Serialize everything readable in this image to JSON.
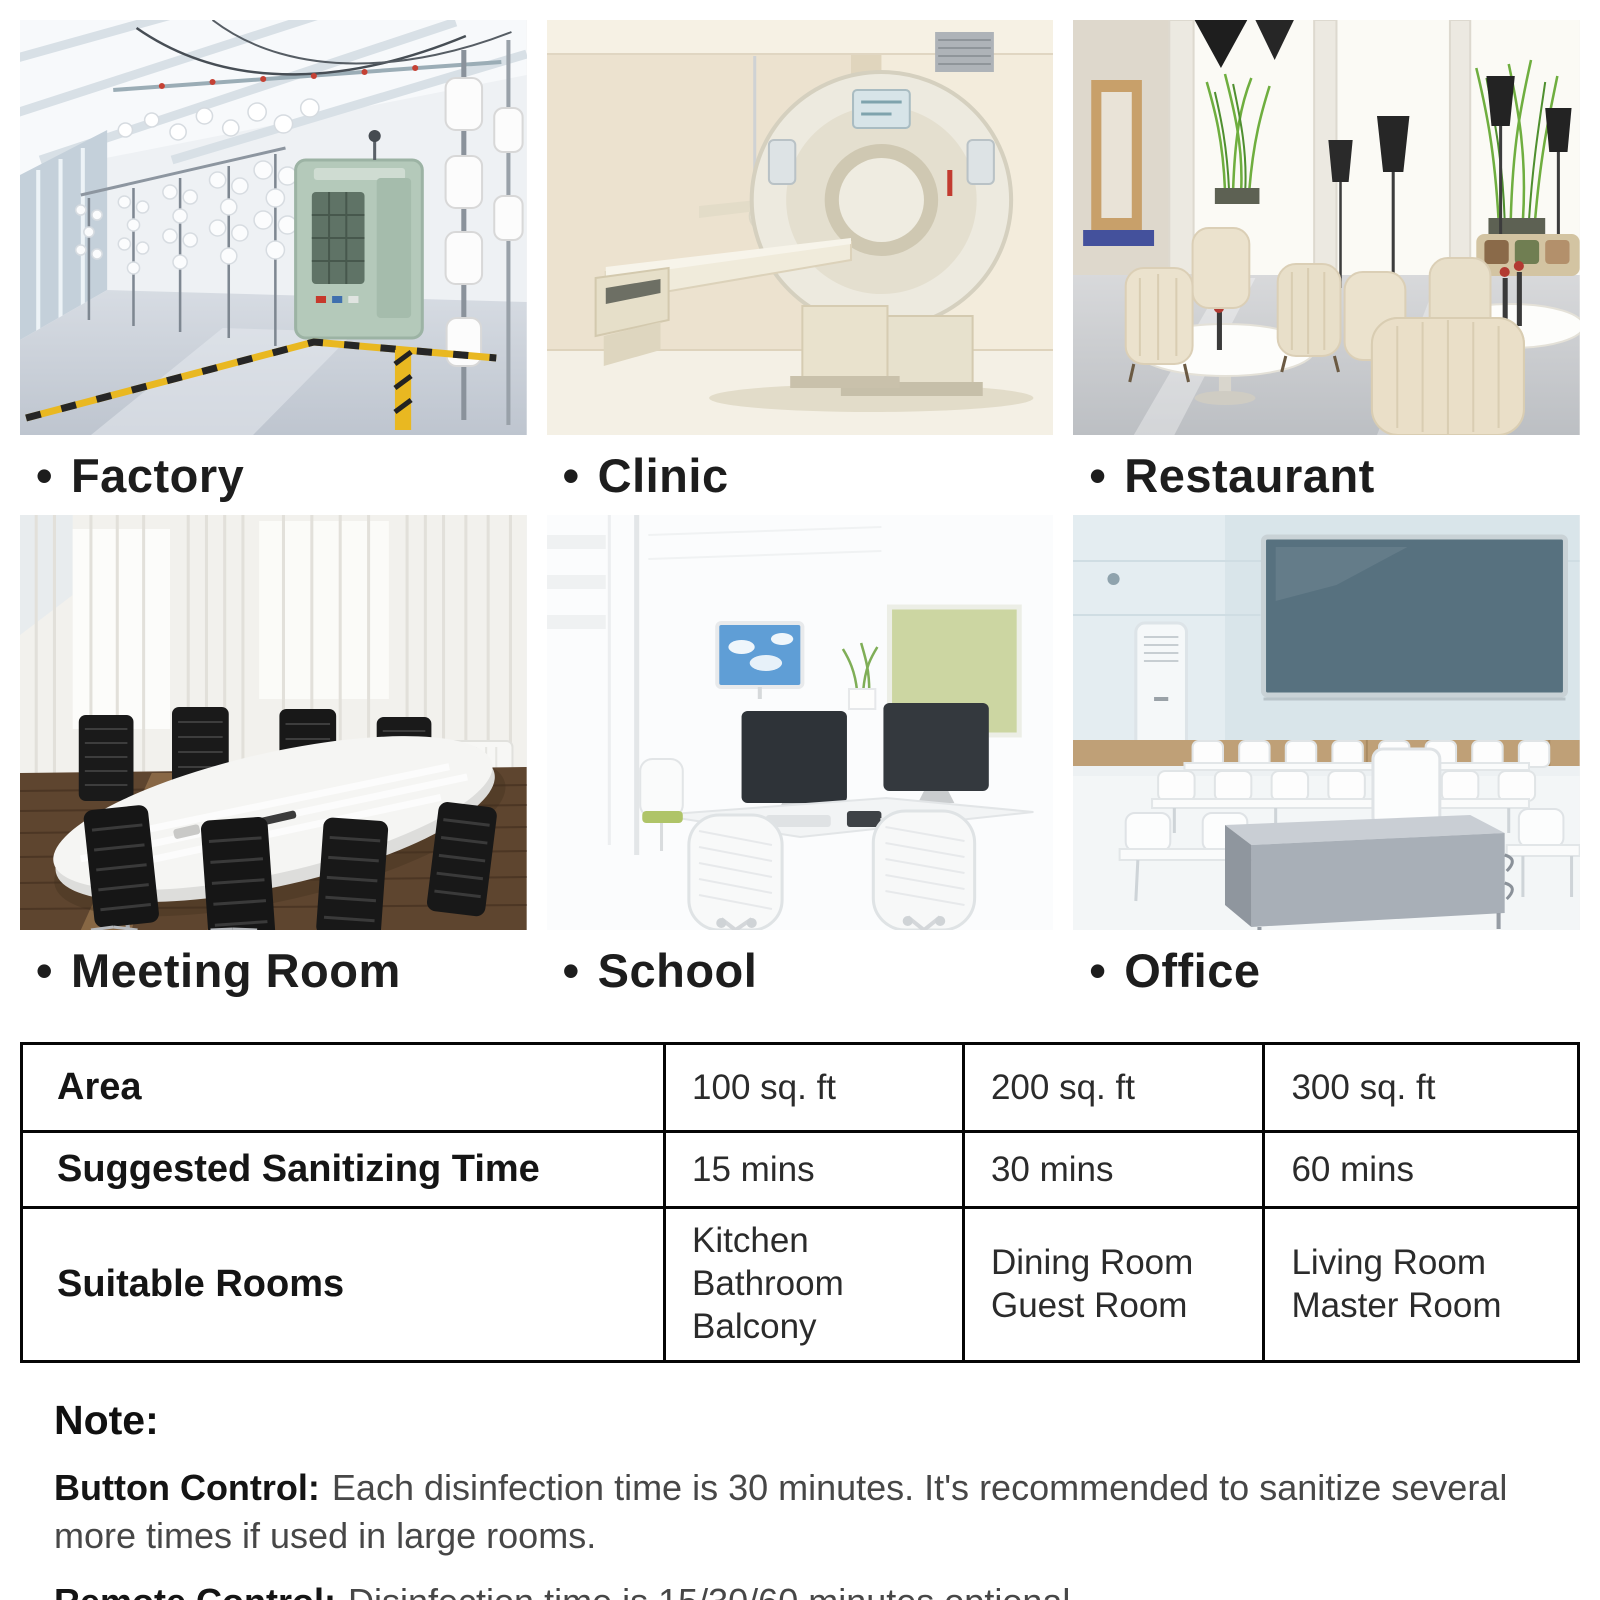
{
  "gallery": {
    "bullet": "•",
    "rows": [
      {
        "items": [
          {
            "label": "Factory",
            "scene": "textile-factory-with-yarn-spools-and-green-knitting-machine"
          },
          {
            "label": "Clinic",
            "scene": "ct-scanner-room-with-beige-walls"
          },
          {
            "label": "Restaurant",
            "scene": "lounge-with-cream-armchairs-round-tables-black-lamps-plants"
          }
        ]
      },
      {
        "items": [
          {
            "label": "Meeting Room",
            "scene": "conference-room-white-oval-table-black-chairs-wood-floor"
          },
          {
            "label": "School",
            "scene": "bright-computer-room-white-desks-monitors-mesh-chairs"
          },
          {
            "label": "Office",
            "scene": "classroom-rows-of-white-desks-blue-board-air-conditioner"
          }
        ]
      }
    ]
  },
  "table": {
    "rows": [
      {
        "header": "Area",
        "cells": [
          "100 sq. ft",
          "200 sq. ft",
          "300 sq. ft"
        ]
      },
      {
        "header": "Suggested Sanitizing Time",
        "cells": [
          "15 mins",
          "30 mins",
          "60 mins"
        ]
      },
      {
        "header": "Suitable Rooms",
        "cells": [
          "Kitchen\nBathroom\nBalcony",
          "Dining Room\nGuest Room",
          "Living Room\nMaster Room"
        ]
      }
    ]
  },
  "note": {
    "title": "Note:",
    "items": [
      {
        "label": "Button Control:",
        "text": "Each disinfection time is 30 minutes. It's recommended to sanitize several more times if used in large rooms."
      },
      {
        "label": "Remote Control:",
        "text": "Disinfection time is 15/30/60 minutes optional."
      }
    ]
  },
  "colors": {
    "caution_yellow": "#e9b821",
    "machine_green": "#b4c9ba",
    "pinboard_green": "#ccd6a2",
    "writing_board_blue": "#57717f",
    "text_dark": "#1f1f1f"
  }
}
